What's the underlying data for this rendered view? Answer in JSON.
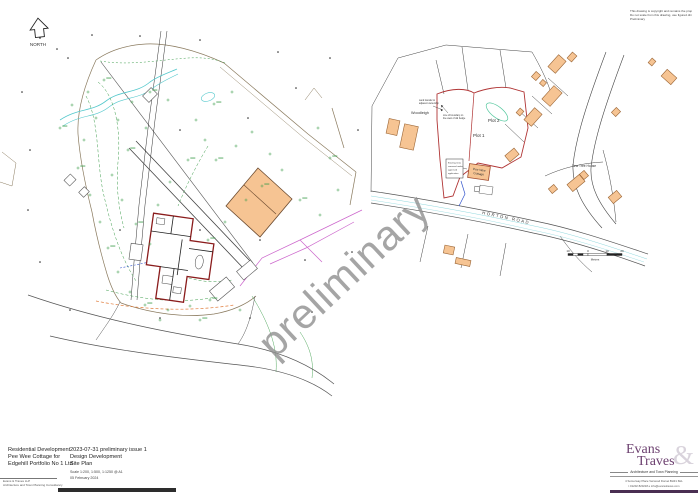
{
  "sheet": {
    "north_label": "NORTH",
    "watermark": "preliminary",
    "disclaimer": {
      "line1": "This drawing is copyright and remains the property of Evans & Traves LLP",
      "line2": "Do not scale from this drawing, use figured dimensions only",
      "line3": "Preliminary"
    }
  },
  "location_plan": {
    "labels": {
      "woodleigh": "Woodleigh",
      "plot1": "Plot 1",
      "plot2": "Plot 2",
      "cottage_l1": "Pee Wee",
      "cottage_l2": "Cottage",
      "yew_tree_house": "Yew Tree House",
      "road": "HORTON ROAD"
    },
    "annotations": {
      "note1_l1": "Land transfer to",
      "note1_l2": "adjacent ownership",
      "note2_l1": "Line of boundary on",
      "note2_l2": "line west of old hedge",
      "note3_l1": "Existing trees",
      "note3_l2": "removed under",
      "note3_l3": "approved",
      "note3_l4": "application"
    },
    "scale_bar": {
      "t0": "10",
      "t1": "0",
      "t2": "10",
      "t3": "20",
      "unit": "Metres"
    }
  },
  "title_block": {
    "project": [
      "Residential Development",
      "Pee Wee Cottage for",
      "Edgehill Portfolio No 1 Ltd"
    ],
    "issue": "2023-07-31 preliminary issue 1",
    "stage": "Design Development",
    "drawing": "Site Plan",
    "scale": "Scale 1:200, 1:500, 1:1250 @ A1",
    "date": "05 February 2024",
    "firm": "Evans & Traves LLP",
    "firm_sub": "Architecture and Town Planning Consultancy"
  },
  "logo": {
    "name1": "Evans",
    "name2": "Traves",
    "amp": "&",
    "tagline": "Architecture and Town Planning",
    "address": "4 Somerway Place    Verwood    Dorset    BH31 6HL",
    "contact": "t  01202 820218      e  info@evanstraves.com"
  },
  "colors": {
    "building_fill": "#F6C493",
    "building_stroke": "#9a6434",
    "site_boundary_red": "#b03434",
    "proposed_red": "#8a1c1c",
    "survey_green": "#3f9e4d",
    "stream_teal": "#54c8cc",
    "magenta": "#cc66cc",
    "logo_purple": "#6d4170"
  }
}
